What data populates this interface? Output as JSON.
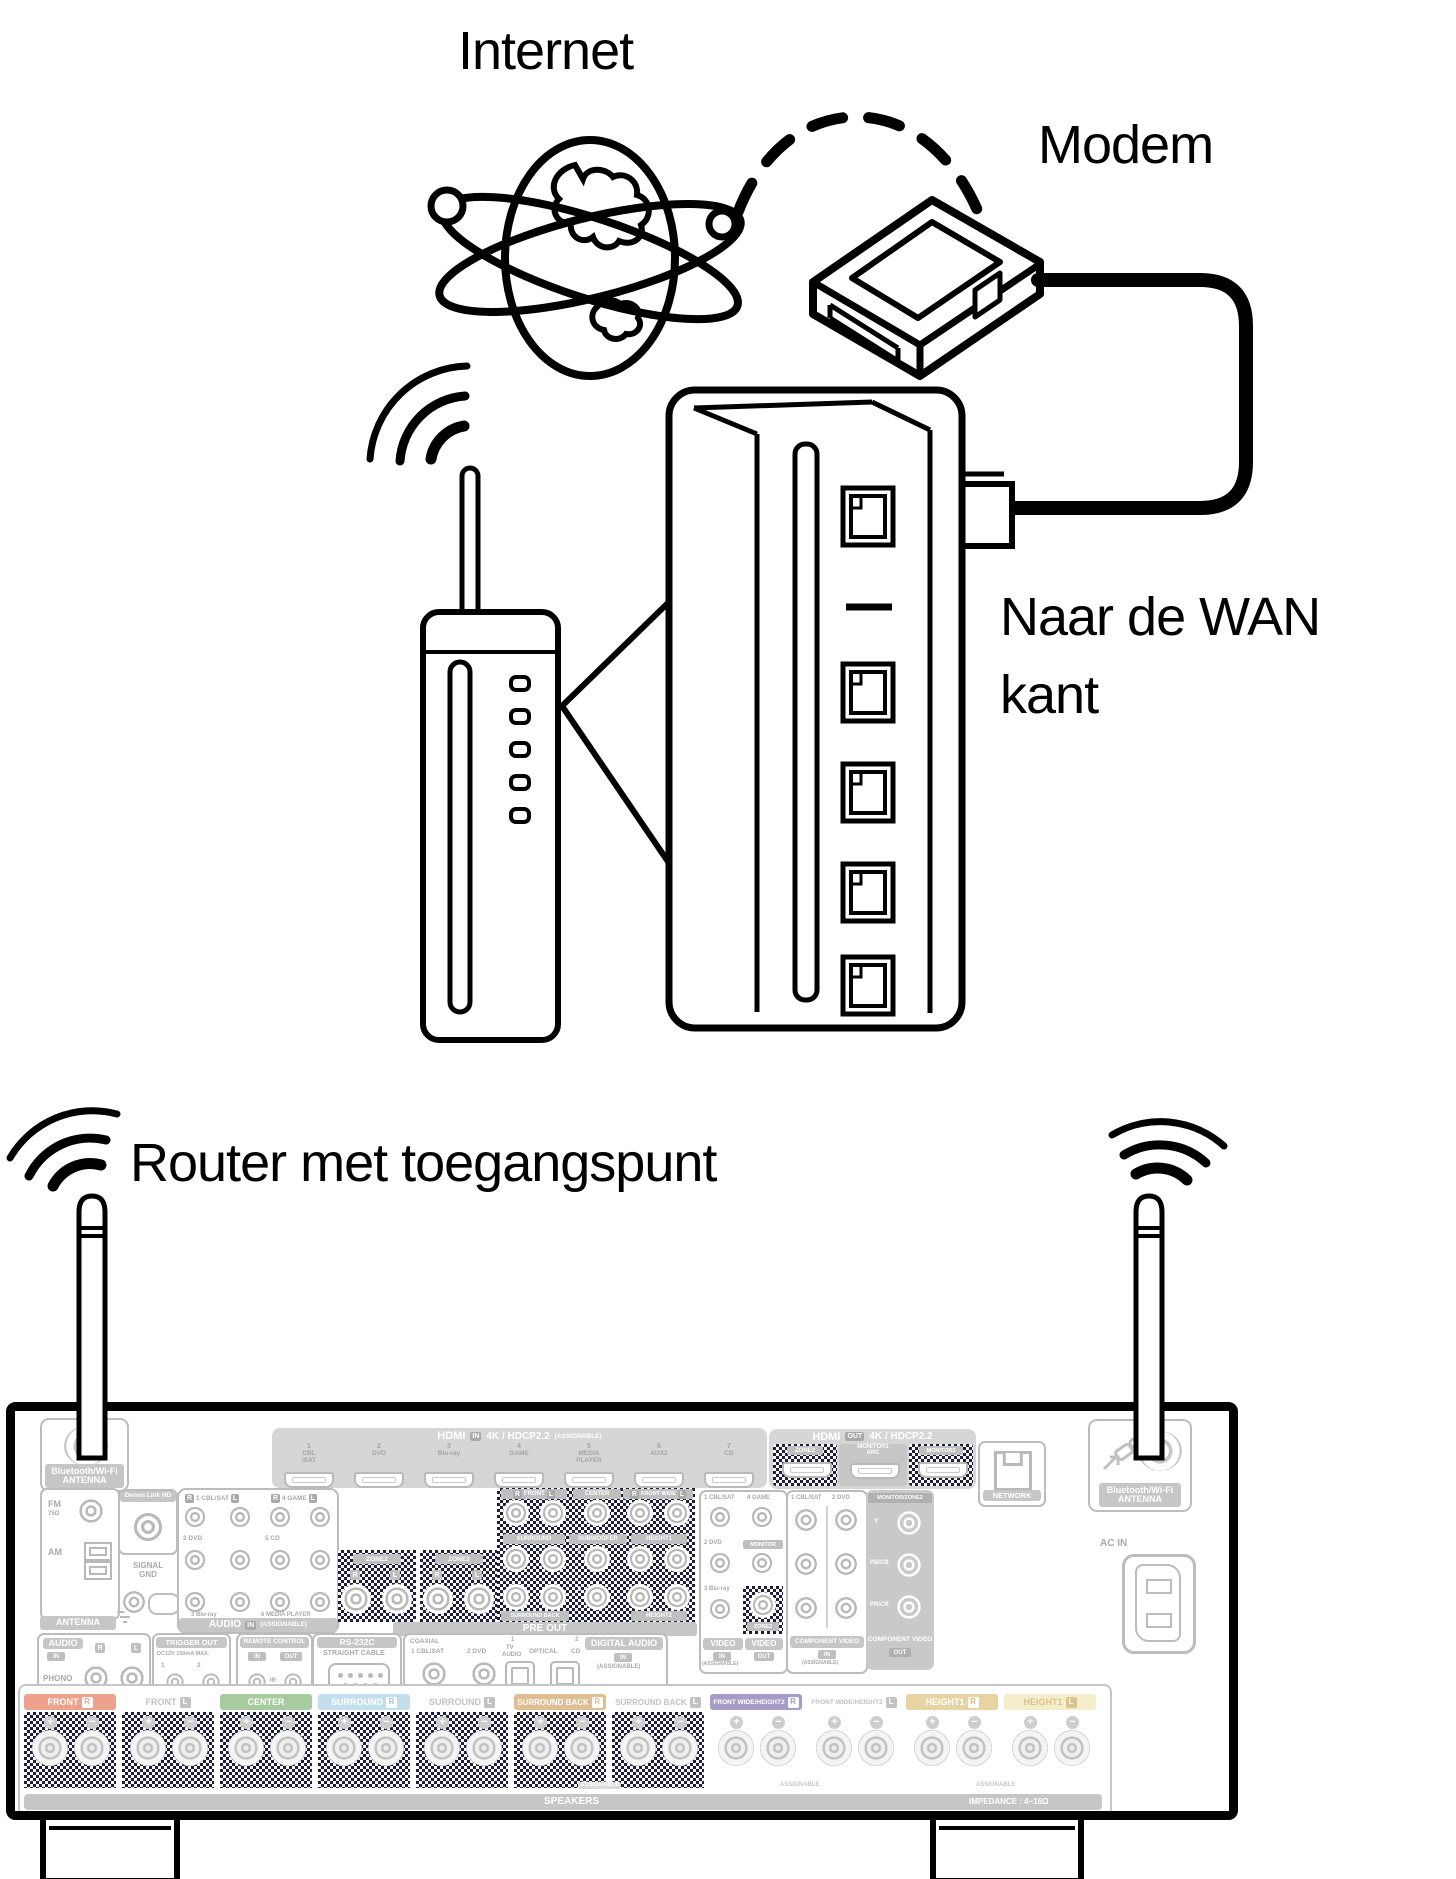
{
  "diagram": {
    "internet_label": "Internet",
    "modem_label": "Modem",
    "wan_label_line1": "Naar de WAN",
    "wan_label_line2": "kant",
    "router_label": "Router met toegangspunt"
  },
  "common": {
    "r": "R",
    "l": "L",
    "in": "IN",
    "out": "OUT",
    "assignable": "(ASSIGNABLE)",
    "assignable_plain": "ASSIGNABLE"
  },
  "receiver": {
    "bt_antenna": {
      "line1": "Bluetooth/Wi-Fi",
      "line2": "ANTENNA"
    },
    "antenna": {
      "fm": "FM",
      "ohm": "75Ω",
      "am": "AM",
      "bar": "ANTENNA"
    },
    "denon_link": "Denon Link HD",
    "signal_gnd": {
      "line1": "SIGNAL",
      "line2": "GND"
    },
    "audio_in": {
      "title": "AUDIO",
      "jack1": "1 CBL/SAT",
      "jack4": "4 GAME",
      "jack2": "2 DVD",
      "jack5": "5 CD",
      "jack3": "3 Blu-ray",
      "jack6": "6 MEDIA PLAYER"
    },
    "hdmi_in": {
      "title": "HDMI",
      "spec": "4K / HDCP2.2",
      "ports": [
        {
          "num": "1",
          "n1": "CBL",
          "n2": "/SAT"
        },
        {
          "num": "2",
          "n1": "DVD",
          "n2": ""
        },
        {
          "num": "3",
          "n1": "Blu-ray",
          "n2": ""
        },
        {
          "num": "4",
          "n1": "GAME",
          "n2": ""
        },
        {
          "num": "5",
          "n1": "MEDIA",
          "n2": "PLAYER"
        },
        {
          "num": "6",
          "n1": "AUX2",
          "n2": ""
        },
        {
          "num": "7",
          "n1": "CD",
          "n2": ""
        }
      ]
    },
    "hdmi_out": {
      "title": "HDMI",
      "spec": "4K / HDCP2.2",
      "zone2": "ZONE2",
      "monitor1": "MONITOR1",
      "arc": "ARC",
      "monitor2": "MONITOR2"
    },
    "network": "NETWORK",
    "ac_in": "AC IN",
    "pre_out": {
      "bar": "PRE OUT",
      "zone2": "ZONE2",
      "zone3": "ZONE3",
      "front": "FRONT",
      "center": "CENTER",
      "front_wide": "FRONT WIDE",
      "surround": "SURROUND",
      "subwoofer": "SUBWOOFER",
      "sub1": "1",
      "sub2": "2",
      "height1": "HEIGHT1",
      "surround_back": "SURROUND BACK",
      "height2": "HEIGHT2"
    },
    "video": {
      "title": "VIDEO",
      "jack1": "1 CBL/SAT",
      "jack4": "4 GAME",
      "jack2": "2 DVD",
      "jack3": "3 Blu-ray",
      "monitor": "MONITOR",
      "zone2": "ZONE2"
    },
    "component_in": {
      "title": "COMPONENT VIDEO",
      "col1": "1 CBL/SAT",
      "col2": "2 DVD"
    },
    "component_out": {
      "title": "COMPONENT VIDEO",
      "header": "MONITOR/ZONE2",
      "y": "Y",
      "pb": "PB/CB",
      "pr": "PR/CR"
    },
    "phono": {
      "title": "AUDIO",
      "label": "PHONO"
    },
    "trigger": {
      "title": "TRIGGER OUT",
      "spec": "DC12V 150mA MAX.",
      "n1": "1",
      "n2": "2"
    },
    "remote": {
      "title": "REMOTE CONTROL",
      "ir": "IR"
    },
    "rs232c": {
      "title": "RS-232C",
      "sub": "STRAIGHT CABLE"
    },
    "digital_audio": {
      "title": "DIGITAL AUDIO",
      "coaxial": "COAXIAL",
      "c1": "1 CBL/SAT",
      "c2": "2 DVD",
      "opt1_num": "1",
      "opt1_a": "TV",
      "opt1_b": "AUDIO",
      "optical": "OPTICAL",
      "opt2_num": "2",
      "opt2": "CD"
    },
    "speakers": {
      "bar": "SPEAKERS",
      "impedance": "IMPEDANCE : 4~16Ω",
      "groups": [
        {
          "label": "FRONT",
          "badge": "R"
        },
        {
          "label": "FRONT",
          "badge": "L"
        },
        {
          "label": "CENTER",
          "badge": ""
        },
        {
          "label": "SURROUND",
          "badge": "R"
        },
        {
          "label": "SURROUND",
          "badge": "L"
        },
        {
          "label": "SURROUND BACK",
          "badge": "R"
        },
        {
          "label": "SURROUND BACK",
          "badge": "L"
        },
        {
          "label": "FRONT WIDE/HEIGHT2",
          "badge": "R"
        },
        {
          "label": "FRONT WIDE/HEIGHT2",
          "badge": "L"
        },
        {
          "label": "HEIGHT1",
          "badge": "R"
        },
        {
          "label": "HEIGHT1",
          "badge": "L"
        }
      ]
    },
    "colors": {
      "front_r": "#eda28e",
      "center": "#a6cb9e",
      "surround_r": "#c3dfee",
      "surround_back_r": "#e0bd92",
      "front_wide_r": "#a99bc7",
      "height1_r": "#e8d3a2",
      "height1_l": "#f6eecb",
      "neutral": "#c2c2c2",
      "hatch": "#1e1e38"
    }
  }
}
